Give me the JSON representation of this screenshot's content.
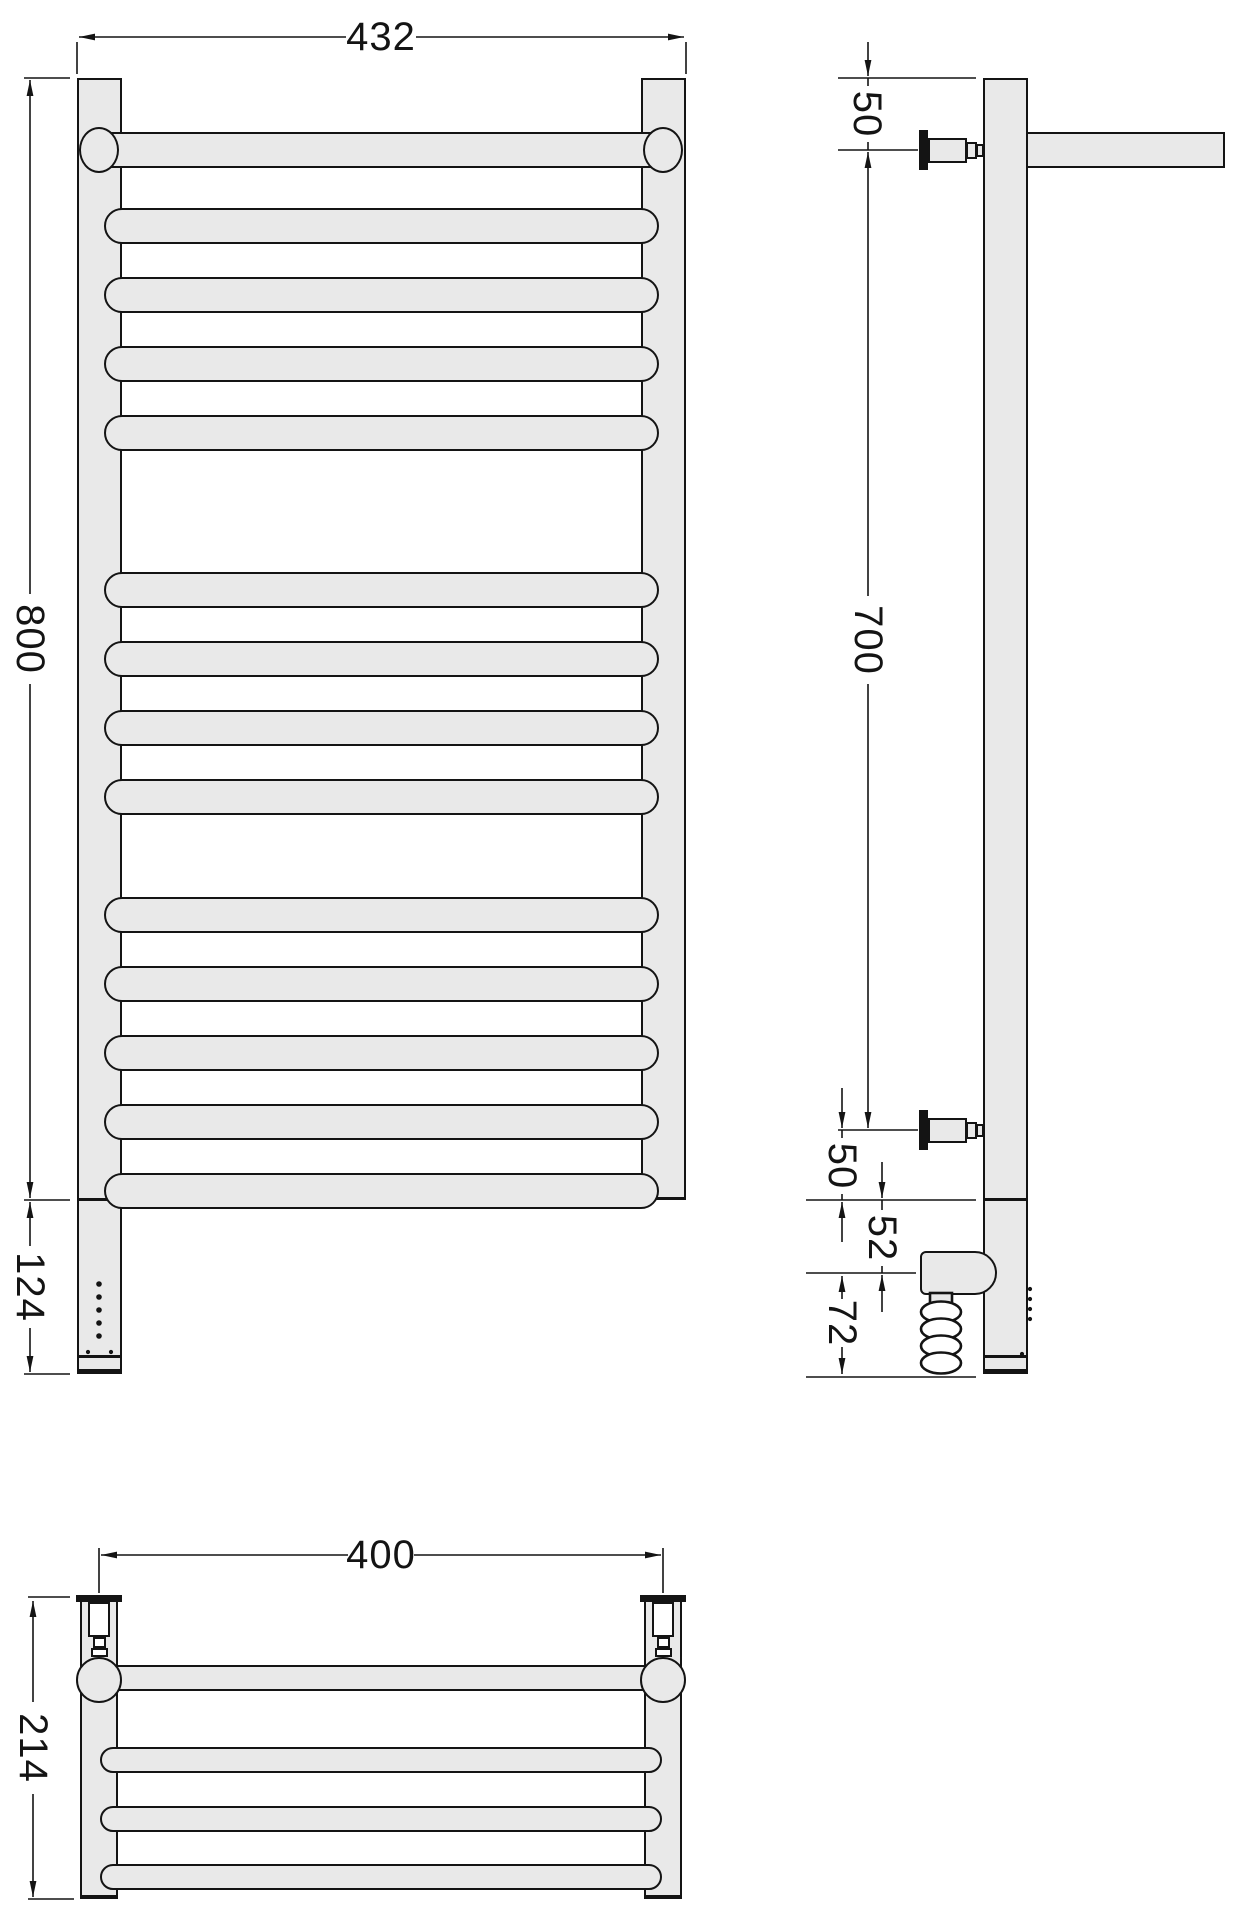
{
  "document": {
    "type": "technical-drawing",
    "subject": "ladder heated towel rail with electric heating element, three orthographic views",
    "background": "#ffffff"
  },
  "style": {
    "fill_color": "#e9e9e9",
    "line_color": "#141414",
    "text_color": "#141414"
  },
  "views": {
    "front": {
      "description": "front view, ladder rail with top bar on ball joints, rung groups of 4-4-5, electric heater section at bottom left",
      "rung_groups": [
        4,
        4,
        5
      ],
      "led_dots": 5,
      "bottom_dots": 2
    },
    "side": {
      "description": "side view with two wall brackets, protruding top rail, thermostat head and coiled power cable",
      "features": [
        "wall-bracket-top",
        "wall-bracket-bottom",
        "thermostat-head",
        "coiled-cable",
        "led-dots"
      ]
    },
    "plan": {
      "description": "plan view with two wall fittings, ball joints, top rail and three rungs",
      "rungs_visible": 3
    }
  },
  "dims": {
    "front_width": "432",
    "front_height": "800",
    "front_heater": "124",
    "side_top": "50",
    "side_span": "700",
    "side_bottom": "50",
    "side_neck": "52",
    "side_heater": "72",
    "plan_width": "400",
    "plan_depth": "214"
  }
}
